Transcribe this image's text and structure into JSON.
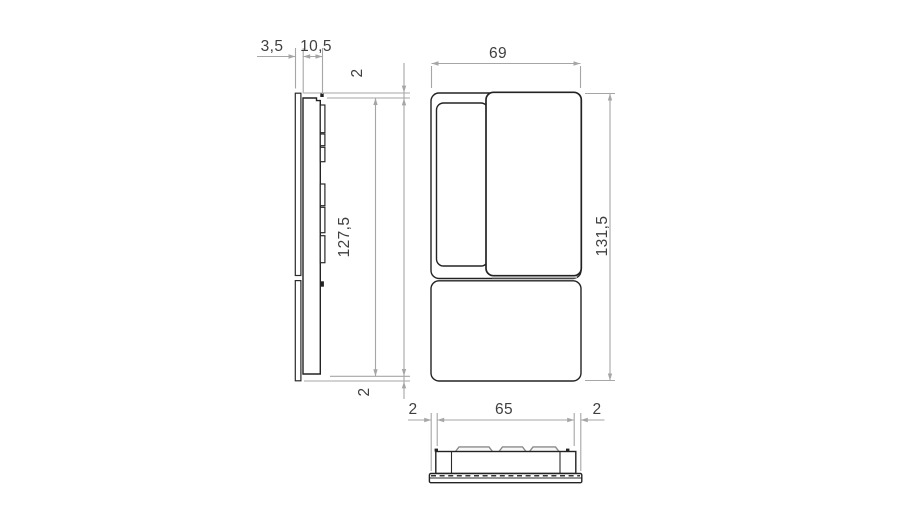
{
  "drawing": {
    "kind": "technical-dimension-drawing",
    "colors": {
      "object_line": "#232323",
      "dimension_line": "#a6a6a6",
      "label_text": "#3f3f3f",
      "background": "#ffffff"
    }
  },
  "views": {
    "side": {
      "label": "side-view",
      "dims": {
        "plate_thickness": "3,5",
        "body_depth": "10,5",
        "top_offset": "2",
        "body_height": "127,5",
        "bottom_offset": "2"
      }
    },
    "front": {
      "label": "front-view",
      "dims": {
        "width": "69",
        "height": "131,5"
      }
    },
    "bottom": {
      "label": "bottom-view",
      "dims": {
        "left_offset": "2",
        "body_width": "65",
        "right_offset": "2"
      }
    }
  }
}
